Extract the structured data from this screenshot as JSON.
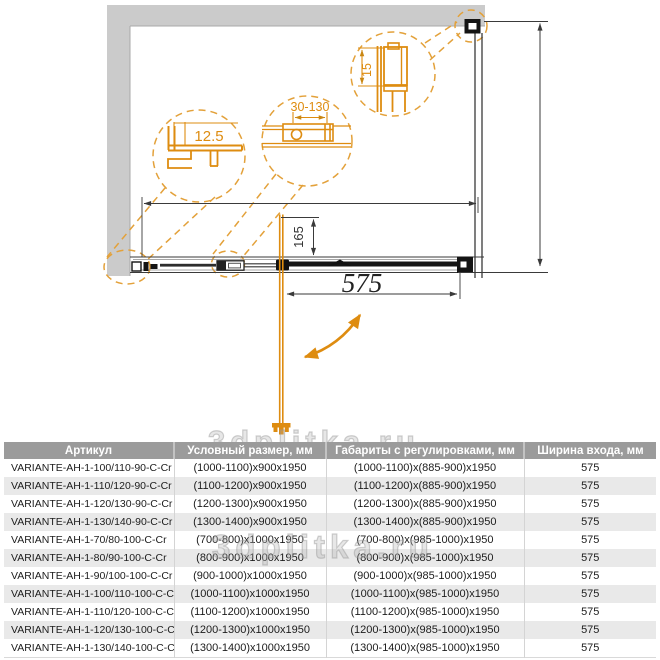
{
  "diagram": {
    "dims": {
      "door_width": "575",
      "handle_offset": "165"
    },
    "details": {
      "wall_profile": "12.5",
      "adjustment_range": "30-130",
      "top_profile": "15"
    }
  },
  "watermark": {
    "text": "3dplitka.ru"
  },
  "table": {
    "headers": {
      "article": "Артикул",
      "nominal_size": "Условный размер, мм",
      "adjusted_size": "Габариты с регулировками, мм",
      "entry_width": "Ширина входа, мм"
    },
    "rows": [
      {
        "article": "VARIANTE-AH-1-100/110-90-C-Cr",
        "nominal": "(1000-1100)x900x1950",
        "adjusted": "(1000-1100)x(885-900)x1950",
        "entry": "575"
      },
      {
        "article": "VARIANTE-AH-1-110/120-90-C-Cr",
        "nominal": "(1100-1200)x900x1950",
        "adjusted": "(1100-1200)x(885-900)x1950",
        "entry": "575"
      },
      {
        "article": "VARIANTE-AH-1-120/130-90-C-Cr",
        "nominal": "(1200-1300)x900x1950",
        "adjusted": "(1200-1300)x(885-900)x1950",
        "entry": "575"
      },
      {
        "article": "VARIANTE-AH-1-130/140-90-C-Cr",
        "nominal": "(1300-1400)x900x1950",
        "adjusted": "(1300-1400)x(885-900)x1950",
        "entry": "575"
      },
      {
        "article": "VARIANTE-AH-1-70/80-100-C-Cr",
        "nominal": "(700-800)x1000x1950",
        "adjusted": "(700-800)x(985-1000)x1950",
        "entry": "575"
      },
      {
        "article": "VARIANTE-AH-1-80/90-100-C-Cr",
        "nominal": "(800-900)x1000x1950",
        "adjusted": "(800-900)x(985-1000)x1950",
        "entry": "575"
      },
      {
        "article": "VARIANTE-AH-1-90/100-100-C-Cr",
        "nominal": "(900-1000)x1000x1950",
        "adjusted": "(900-1000)x(985-1000)x1950",
        "entry": "575"
      },
      {
        "article": "VARIANTE-AH-1-100/110-100-C-Cr",
        "nominal": "(1000-1100)x1000x1950",
        "adjusted": "(1000-1100)x(985-1000)x1950",
        "entry": "575"
      },
      {
        "article": "VARIANTE-AH-1-110/120-100-C-Cr",
        "nominal": "(1100-1200)x1000x1950",
        "adjusted": "(1100-1200)x(985-1000)x1950",
        "entry": "575"
      },
      {
        "article": "VARIANTE-AH-1-120/130-100-C-Cr",
        "nominal": "(1200-1300)x1000x1950",
        "adjusted": "(1200-1300)x(985-1000)x1950",
        "entry": "575"
      },
      {
        "article": "VARIANTE-AH-1-130/140-100-C-Cr",
        "nominal": "(1300-1400)x1000x1950",
        "adjusted": "(1300-1400)x(985-1000)x1950",
        "entry": "575"
      }
    ]
  },
  "colors": {
    "accent_orange": "#de8c10",
    "dash_orange": "#e3a13a",
    "wall_gray": "#cbcbcb",
    "header_gray": "#9b9b9b",
    "row_alt": "#e9e9e9",
    "line_dark": "#3a3a3a"
  }
}
